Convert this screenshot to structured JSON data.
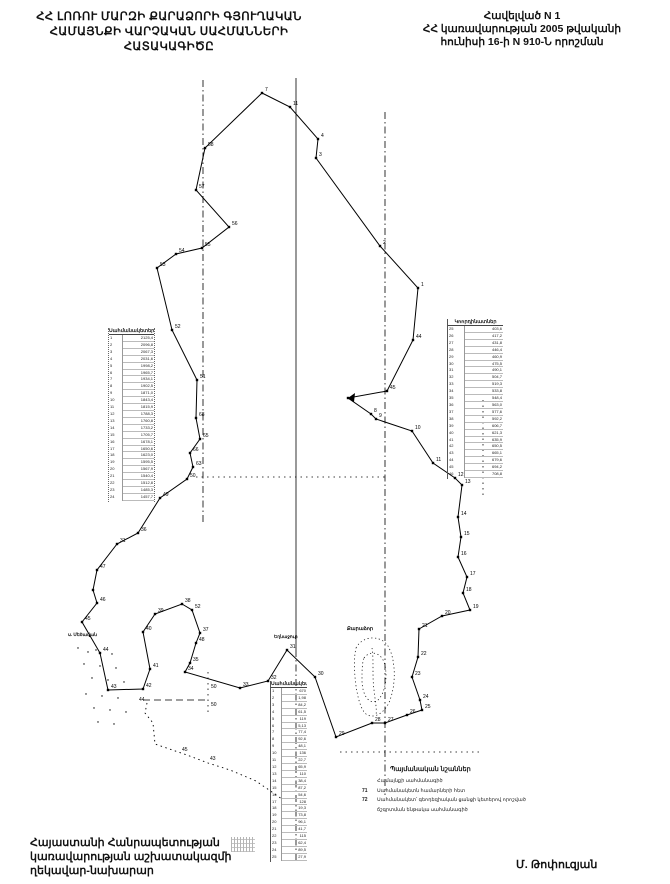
{
  "document": {
    "title_lines": [
      "ՀՀ ԼՈՌՈՒ ՄԱՐԶԻ ՔԱՐԱՁՈՐԻ ԳՅՈՒՂԱԿԱՆ",
      "ՀԱՄԱՅՆՔԻ ՎԱՐՉԱԿԱՆ ՍԱՀՄԱՆՆԵՐԻ",
      "ՀԱՏԱԿԱԳԻԾԸ"
    ],
    "appendix_lines": [
      "Հավելված N 1",
      "ՀՀ կառավարության 2005 թվականի",
      "հունիսի 16-ի N 910-Ն որոշման"
    ],
    "signature_lines": [
      "Հայաստանի Հանրապետության",
      "կառավարության աշխատակազմի",
      "ղեկավար-նախարար"
    ],
    "signer": "Մ. Թոփուզյան"
  },
  "legend": {
    "title": "Պայմանական նշաններ",
    "items": [
      {
        "marker": "",
        "label": "Համայնքի սահմանագիծ"
      },
      {
        "marker": "71",
        "label": "Սահմանակետն համարների հետ"
      },
      {
        "marker": "72",
        "label": "Սահմանակետ՝ գեոդեզիական ցանցի կետերով որոշված"
      },
      {
        "marker": "",
        "label": "ճշգրտման ենթակա սահմանագիծ"
      }
    ]
  },
  "map": {
    "ink": "#000000",
    "paper": "#ffffff",
    "labels": [
      {
        "text": "ս. Մեծավան",
        "x": 68,
        "y": 635,
        "size": 4.5
      },
      {
        "text": "Եղնաջուր",
        "x": 274,
        "y": 637,
        "size": 4.5
      },
      {
        "text": "Քարաձոր",
        "x": 347,
        "y": 629,
        "size": 5
      }
    ],
    "boundary": [
      [
        262,
        93,
        "7"
      ],
      [
        290,
        107,
        "11"
      ],
      [
        318,
        139,
        "4"
      ],
      [
        316,
        158,
        "3"
      ],
      [
        380,
        246,
        "2"
      ],
      [
        418,
        288,
        "1"
      ],
      [
        413,
        340,
        "44"
      ],
      [
        387,
        391,
        "45"
      ],
      [
        348,
        398,
        ""
      ],
      [
        371,
        414,
        "8"
      ],
      [
        376,
        419,
        "9"
      ],
      [
        412,
        431,
        "10"
      ],
      [
        433,
        463,
        "11"
      ],
      [
        455,
        478,
        "12"
      ],
      [
        462,
        485,
        "13"
      ],
      [
        458,
        517,
        "14"
      ],
      [
        461,
        537,
        "15"
      ],
      [
        458,
        557,
        "16"
      ],
      [
        467,
        577,
        "17"
      ],
      [
        463,
        593,
        "18"
      ],
      [
        470,
        610,
        "19"
      ],
      [
        442,
        616,
        "20"
      ],
      [
        419,
        629,
        "21"
      ],
      [
        418,
        657,
        "22"
      ],
      [
        412,
        677,
        "23"
      ],
      [
        420,
        700,
        "24"
      ],
      [
        422,
        710,
        "25"
      ],
      [
        407,
        715,
        "26"
      ],
      [
        385,
        723,
        "27"
      ],
      [
        372,
        723,
        "28"
      ],
      [
        336,
        737,
        "29"
      ],
      [
        315,
        677,
        "30"
      ],
      [
        287,
        650,
        "31"
      ],
      [
        268,
        681,
        "32"
      ],
      [
        240,
        688,
        "33"
      ],
      [
        185,
        672,
        "34"
      ],
      [
        190,
        663,
        "35"
      ],
      [
        196,
        643,
        "48"
      ],
      [
        200,
        633,
        "37"
      ],
      [
        192,
        610,
        "52"
      ],
      [
        182,
        604,
        "38"
      ],
      [
        155,
        614,
        "39"
      ],
      [
        143,
        632,
        "40"
      ],
      [
        150,
        669,
        "41"
      ],
      [
        143,
        689,
        "42"
      ],
      [
        108,
        690,
        "43"
      ],
      [
        100,
        653,
        "44"
      ],
      [
        82,
        622,
        "45"
      ],
      [
        97,
        603,
        "46"
      ],
      [
        93,
        590,
        ""
      ],
      [
        97,
        570,
        "47"
      ],
      [
        117,
        544,
        "31"
      ],
      [
        138,
        533,
        "36"
      ],
      [
        160,
        498,
        "49"
      ],
      [
        187,
        479,
        "50"
      ],
      [
        193,
        467,
        "63"
      ],
      [
        190,
        453,
        "66"
      ],
      [
        200,
        439,
        "65"
      ],
      [
        196,
        418,
        "68"
      ],
      [
        197,
        380,
        "51"
      ],
      [
        172,
        330,
        "52"
      ],
      [
        157,
        268,
        "53"
      ],
      [
        176,
        254,
        "54"
      ],
      [
        202,
        248,
        "55"
      ],
      [
        229,
        227,
        "56"
      ],
      [
        196,
        190,
        "57"
      ],
      [
        205,
        148,
        "58"
      ]
    ],
    "lobe": [
      [
        147,
        703
      ],
      [
        145,
        713
      ],
      [
        153,
        723
      ],
      [
        155,
        744
      ],
      [
        187,
        755
      ],
      [
        208,
        763
      ],
      [
        230,
        770
      ],
      [
        256,
        781
      ],
      [
        282,
        799
      ]
    ],
    "lobe_labels": [
      {
        "text": "44",
        "x": 139,
        "y": 701
      },
      {
        "text": "45",
        "x": 182,
        "y": 751
      },
      {
        "text": "43",
        "x": 210,
        "y": 760
      },
      {
        "text": "50",
        "x": 211,
        "y": 688
      },
      {
        "text": "50",
        "x": 211,
        "y": 706
      }
    ],
    "ref_lines": [
      {
        "style": "dashdot",
        "x1": 203,
        "y1": 80,
        "x2": 203,
        "y2": 525
      },
      {
        "style": "solid",
        "x1": 296,
        "y1": 78,
        "x2": 296,
        "y2": 650
      },
      {
        "style": "dashdot",
        "x1": 296,
        "y1": 650,
        "x2": 296,
        "y2": 862
      },
      {
        "style": "dashdot",
        "x1": 385,
        "y1": 112,
        "x2": 385,
        "y2": 795
      },
      {
        "style": "dot",
        "x1": 483,
        "y1": 400,
        "x2": 483,
        "y2": 495
      },
      {
        "style": "dot",
        "x1": 196,
        "y1": 477,
        "x2": 385,
        "y2": 477
      },
      {
        "style": "dot",
        "x1": 340,
        "y1": 752,
        "x2": 480,
        "y2": 752
      },
      {
        "style": "dash",
        "x1": 143,
        "y1": 700,
        "x2": 208,
        "y2": 700
      },
      {
        "style": "dot",
        "x1": 208,
        "y1": 672,
        "x2": 208,
        "y2": 712
      }
    ],
    "settlement_paths": [
      "M356,648 C362,636 380,634 388,646 C396,660 396,684 390,700 C386,712 374,720 366,714 C356,706 352,664 356,648",
      "M364,658 C370,650 380,652 384,662 C388,674 386,692 378,700 C370,706 362,696 362,680 C362,670 362,664 364,658",
      "M372,648 C374,660 372,676 374,690 C375,700 377,708 376,716"
    ],
    "scatter": [
      [
        78,
        648
      ],
      [
        88,
        652
      ],
      [
        96,
        650
      ],
      [
        112,
        654
      ],
      [
        84,
        664
      ],
      [
        100,
        666
      ],
      [
        116,
        668
      ],
      [
        92,
        678
      ],
      [
        108,
        680
      ],
      [
        124,
        682
      ],
      [
        86,
        694
      ],
      [
        102,
        696
      ],
      [
        118,
        698
      ],
      [
        94,
        708
      ],
      [
        110,
        710
      ],
      [
        126,
        712
      ],
      [
        98,
        722
      ],
      [
        114,
        724
      ]
    ],
    "arrow": [
      [
        348,
        398
      ],
      [
        355,
        393
      ],
      [
        354,
        402
      ]
    ]
  },
  "tables": [
    {
      "header": "Սահմանակետեր",
      "x": 108,
      "y": 328,
      "w": 47,
      "h": 174,
      "frame": "dotted",
      "rows": [
        [
          "1",
          "2125,4"
        ],
        [
          "2",
          "2096,8"
        ],
        [
          "3",
          "2067,3"
        ],
        [
          "4",
          "2031,6"
        ],
        [
          "5",
          "1998,2"
        ],
        [
          "6",
          "1965,7"
        ],
        [
          "7",
          "1934,1"
        ],
        [
          "8",
          "1902,5"
        ],
        [
          "9",
          "1871,0"
        ],
        [
          "10",
          "1843,4"
        ],
        [
          "11",
          "1815,9"
        ],
        [
          "12",
          "1788,3"
        ],
        [
          "13",
          "1760,8"
        ],
        [
          "14",
          "1733,2"
        ],
        [
          "15",
          "1705,7"
        ],
        [
          "16",
          "1678,1"
        ],
        [
          "17",
          "1650,6"
        ],
        [
          "18",
          "1623,0"
        ],
        [
          "19",
          "1595,5"
        ],
        [
          "20",
          "1567,9"
        ],
        [
          "21",
          "1540,4"
        ],
        [
          "22",
          "1512,8"
        ],
        [
          "23",
          "1485,3"
        ],
        [
          "24",
          "1457,7"
        ]
      ]
    },
    {
      "header": "Կոորդինատներ",
      "x": 447,
      "y": 319,
      "w": 56,
      "h": 160,
      "frame": "solid",
      "rows": [
        [
          "25",
          "403,6"
        ],
        [
          "26",
          "417,2"
        ],
        [
          "27",
          "431,8"
        ],
        [
          "28",
          "446,4"
        ],
        [
          "29",
          "460,9"
        ],
        [
          "30",
          "475,5"
        ],
        [
          "31",
          "490,1"
        ],
        [
          "32",
          "504,7"
        ],
        [
          "33",
          "519,3"
        ],
        [
          "34",
          "533,8"
        ],
        [
          "35",
          "548,4"
        ],
        [
          "36",
          "563,0"
        ],
        [
          "37",
          "577,6"
        ],
        [
          "38",
          "592,2"
        ],
        [
          "39",
          "606,7"
        ],
        [
          "40",
          "621,3"
        ],
        [
          "41",
          "635,9"
        ],
        [
          "42",
          "650,5"
        ],
        [
          "43",
          "665,1"
        ],
        [
          "44",
          "679,6"
        ],
        [
          "45",
          "694,2"
        ],
        [
          "46",
          "708,8"
        ]
      ]
    },
    {
      "header": "Սահմանակետեր",
      "x": 270,
      "y": 681,
      "w": 37,
      "h": 181,
      "frame": "solid",
      "rows": [
        [
          "1",
          "670"
        ],
        [
          "2",
          "1,98"
        ],
        [
          "3",
          "84,2"
        ],
        [
          "4",
          "61,5"
        ],
        [
          "5",
          "119"
        ],
        [
          "6",
          "5,13"
        ],
        [
          "7",
          "77,4"
        ],
        [
          "8",
          "92,6"
        ],
        [
          "9",
          "48,1"
        ],
        [
          "10",
          "136"
        ],
        [
          "11",
          "22,7"
        ],
        [
          "12",
          "65,9"
        ],
        [
          "13",
          "110"
        ],
        [
          "14",
          "38,4"
        ],
        [
          "15",
          "87,2"
        ],
        [
          "16",
          "54,6"
        ],
        [
          "17",
          "128"
        ],
        [
          "18",
          "19,3"
        ],
        [
          "19",
          "73,8"
        ],
        [
          "20",
          "96,1"
        ],
        [
          "21",
          "41,7"
        ],
        [
          "22",
          "115"
        ],
        [
          "23",
          "62,4"
        ],
        [
          "24",
          "89,5"
        ],
        [
          "25",
          "27,9"
        ]
      ]
    }
  ]
}
